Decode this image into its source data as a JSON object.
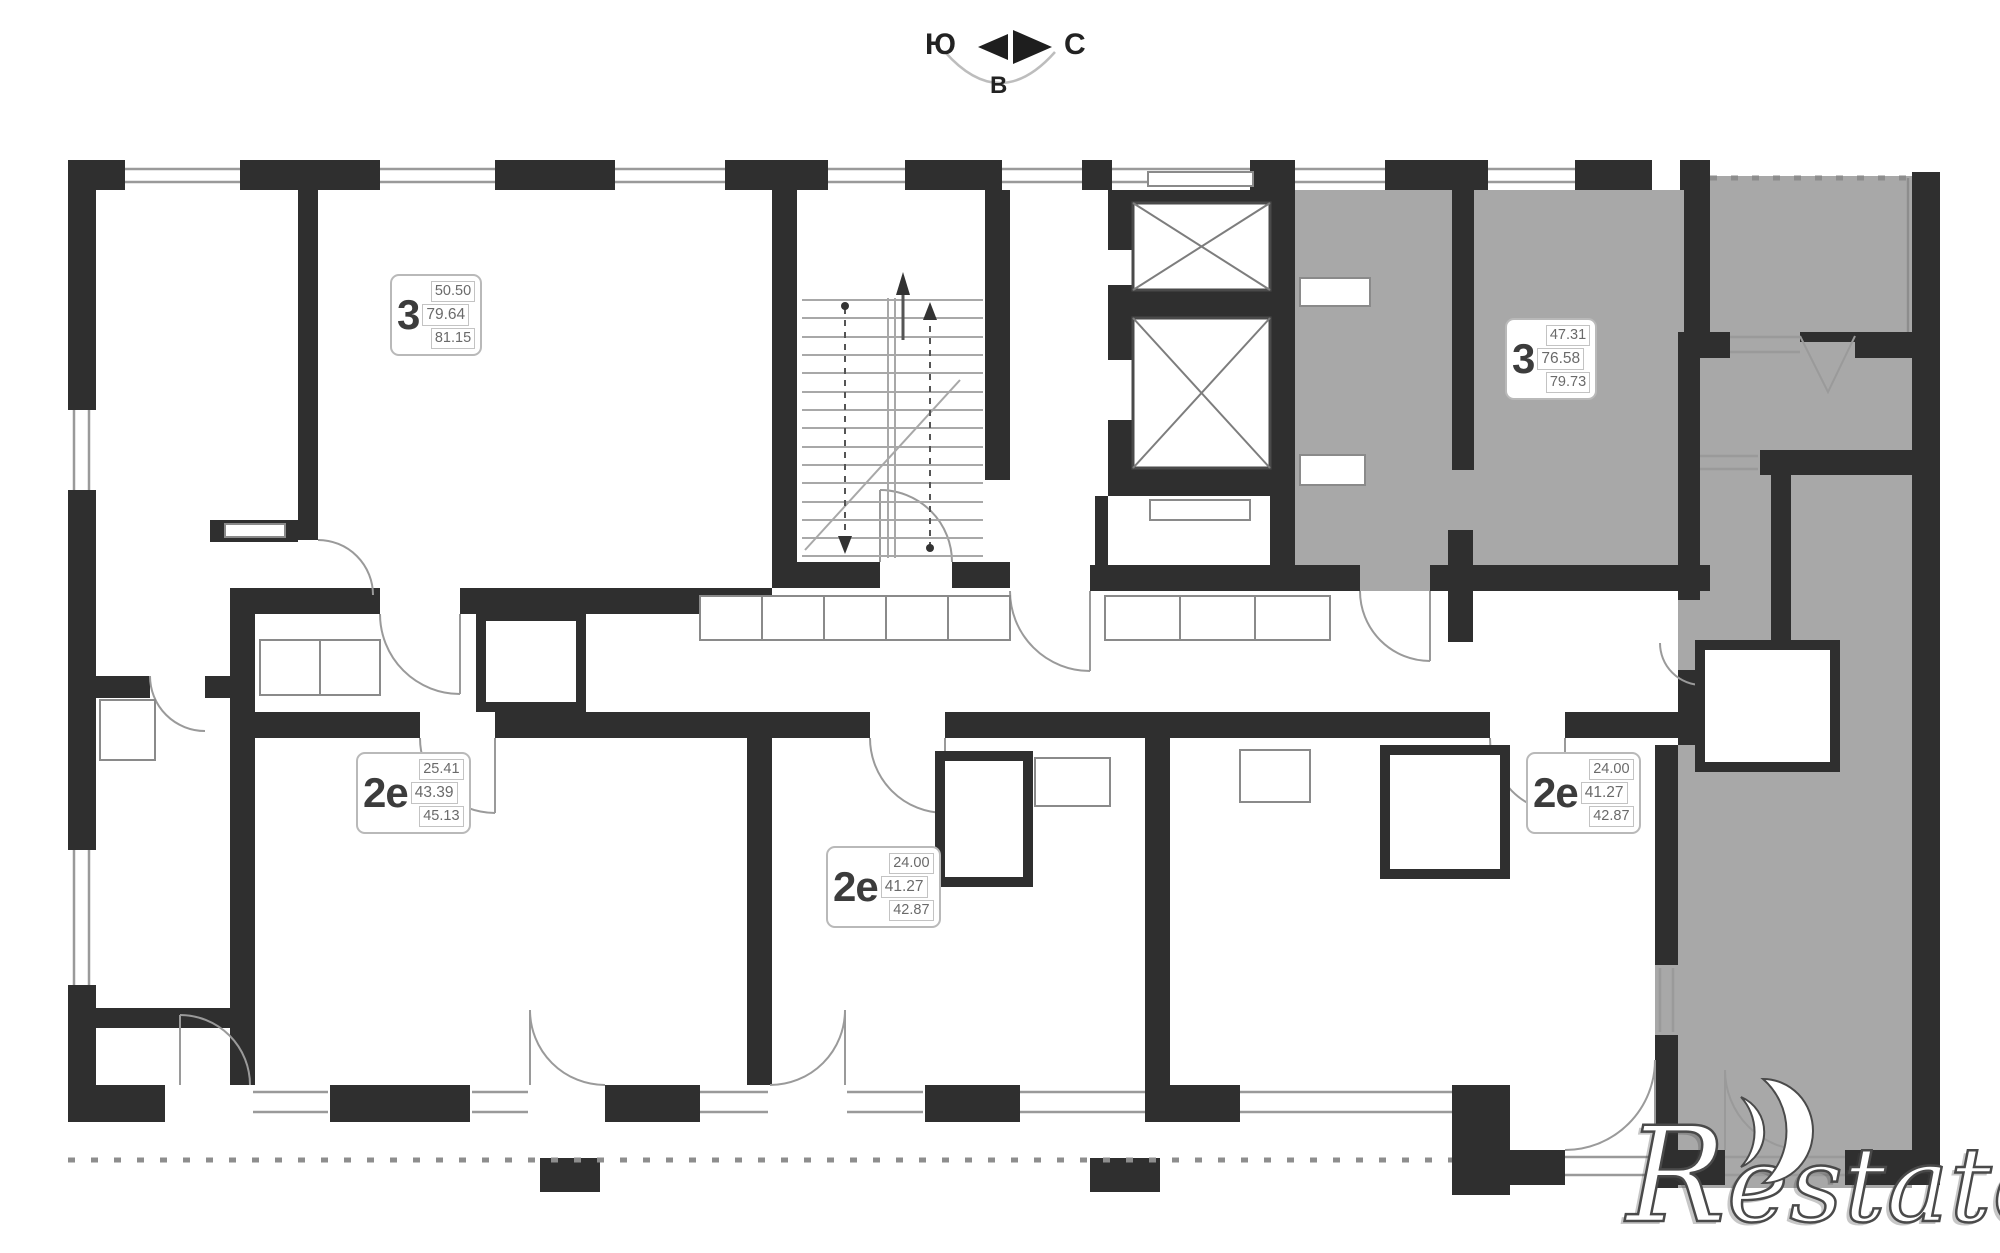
{
  "compass": {
    "left": "Ю",
    "right": "С",
    "bottom": "В"
  },
  "apartments": [
    {
      "type": "3",
      "area_living": "50.50",
      "area_main": "79.64",
      "area_total": "81.15"
    },
    {
      "type": "3",
      "area_living": "47.31",
      "area_main": "76.58",
      "area_total": "79.73"
    },
    {
      "type": "2е",
      "area_living": "25.41",
      "area_main": "43.39",
      "area_total": "45.13"
    },
    {
      "type": "2е",
      "area_living": "24.00",
      "area_main": "41.27",
      "area_total": "42.87"
    },
    {
      "type": "2е",
      "area_living": "24.00",
      "area_main": "41.27",
      "area_total": "42.87"
    }
  ],
  "watermark": {
    "initial": "R",
    "rest": "estate"
  },
  "colors": {
    "wall": "#2f2f2f",
    "highlight_fill": "#a8a8a8",
    "thin_line": "#9a9a9a"
  }
}
